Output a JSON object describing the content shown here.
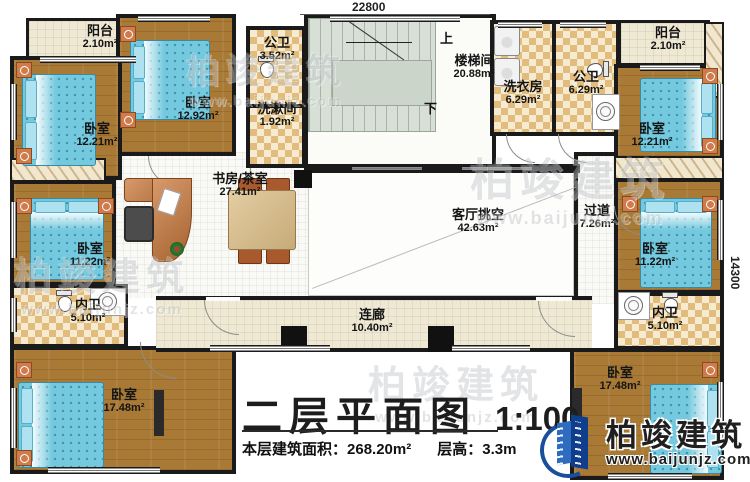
{
  "dimensions": {
    "width_top": "22800",
    "height_right": "14300"
  },
  "rooms": {
    "balcony_tl": {
      "label": "阳台",
      "area": "2.10m²"
    },
    "bedroom_tm": {
      "label": "卧室",
      "area": "12.92m²"
    },
    "bedroom_tl": {
      "label": "卧室",
      "area": "12.21m²"
    },
    "public_bath_small": {
      "label": "公卫",
      "area": "3.52m²"
    },
    "washroom": {
      "label": "洗漱间",
      "area": "1.92m²"
    },
    "stairwell": {
      "label": "楼梯间",
      "area": "20.88m²"
    },
    "laundry": {
      "label": "洗衣房",
      "area": "6.29m²"
    },
    "public_bath_large": {
      "label": "公卫",
      "area": "6.29m²"
    },
    "balcony_tr": {
      "label": "阳台",
      "area": "2.10m²"
    },
    "bedroom_tr": {
      "label": "卧室",
      "area": "12.21m²"
    },
    "study_tea": {
      "label": "书房/茶室",
      "area": "27.41m²"
    },
    "living_void": {
      "label": "客厅挑空",
      "area": "42.63m²"
    },
    "hallway": {
      "label": "过道",
      "area": "7.26m²"
    },
    "bedroom_ml": {
      "label": "卧室",
      "area": "11.22m²"
    },
    "bedroom_mr": {
      "label": "卧室",
      "area": "11.22m²"
    },
    "inner_bath_l": {
      "label": "内卫",
      "area": "5.10m²"
    },
    "inner_bath_r": {
      "label": "内卫",
      "area": "5.10m²"
    },
    "bedroom_bl": {
      "label": "卧室",
      "area": "17.48m²"
    },
    "bedroom_br": {
      "label": "卧室",
      "area": "17.48m²"
    },
    "corridor": {
      "label": "连廊",
      "area": "10.40m²"
    }
  },
  "stairs": {
    "up": "上",
    "down": "下"
  },
  "title": {
    "main": "二层平面图",
    "scale": "1:100",
    "floor_area_label": "本层建筑面积：",
    "floor_area_value": "268.20m²",
    "floor_height_label": "层高：",
    "floor_height_value": "3.3m"
  },
  "logo": {
    "name": "柏竣建筑",
    "website": "www.baijunjz.com"
  },
  "watermark": {
    "brand": "柏竣建筑",
    "website": "www.baijunjz.com"
  },
  "colors": {
    "wall": "#1a1a1a",
    "wood_floor": "#a97a36",
    "tile": "#e2bc7c",
    "bed": "#74c9de",
    "logo_blue": "#1b4f9c"
  }
}
